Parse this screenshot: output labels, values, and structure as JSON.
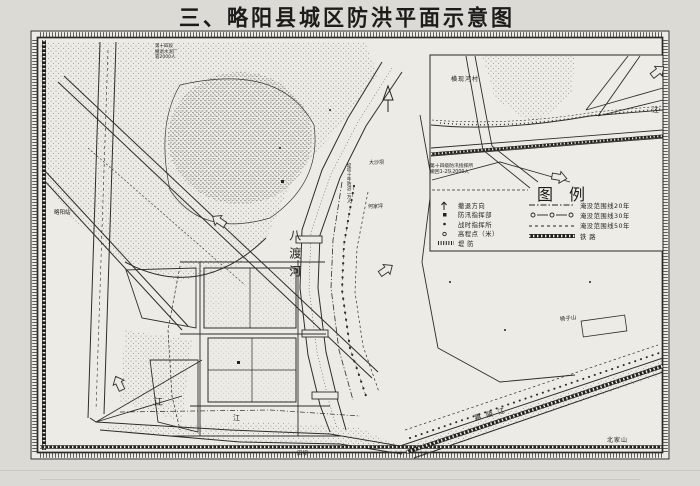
{
  "title": "三、略阳县城区防洪平面示意图",
  "legend": {
    "heading": "图例",
    "left_items": [
      {
        "symbol": "evacuation-arrow",
        "label": "撤退方向"
      },
      {
        "symbol": "hq-square",
        "label": "防汛指挥部"
      },
      {
        "symbol": "post-dot",
        "label": "战时指挥所"
      },
      {
        "symbol": "elevation-circle",
        "label": "高程点（米）"
      },
      {
        "symbol": "dike-band",
        "label": "堤  防"
      }
    ],
    "right_items": [
      {
        "symbol": "dash-dot-line",
        "label": "淹没范围线20年"
      },
      {
        "symbol": "o-dash-line",
        "label": "淹没范围线30年"
      },
      {
        "symbol": "dashed-line",
        "label": "淹没范围线50年"
      },
      {
        "symbol": "railway-band",
        "label": "铁  路"
      }
    ]
  },
  "inset": {
    "village_label": "横现河村",
    "note_line1": "第十四级防汛指挥所",
    "note_line2": "撤回1-2队2000人",
    "river_char": "江"
  },
  "map_labels": {
    "river_badu": "八渡河",
    "river_jialing": "嘉陵江",
    "jiang1": "江",
    "jiang2": "江",
    "station": "略阳站",
    "dashaba": "大沙坝",
    "hejiaping": "何家坪",
    "yangzishan": "杨子山",
    "tianba": "田坝",
    "beijiashan": "北家山",
    "note_line1": "第十四段",
    "note_line2": "撤退水泥厂",
    "note_line3": "容2000人",
    "dike_note": "堤坝十年防洪二万人"
  }
}
